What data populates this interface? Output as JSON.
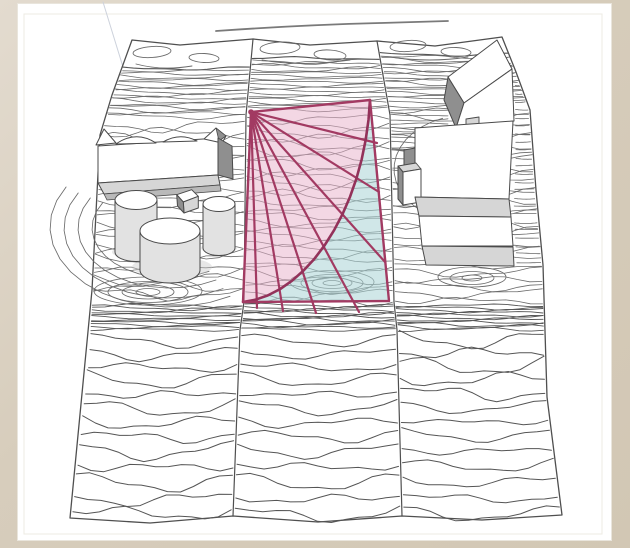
{
  "scene": {
    "kind": "3d-site-contour-model",
    "lots": 3,
    "left_cluster": {
      "slab_buildings": 1,
      "cylinders": 3,
      "small_box": 1
    },
    "right_cluster": {
      "boxes": 5
    },
    "parcel_overlay": {
      "rays": 7,
      "has_arc": true,
      "zones": [
        "pink-sector",
        "blue-remainder"
      ]
    }
  },
  "colors": {
    "frame_bg": "#d7cdbc",
    "card_bg": "#ffffff",
    "card_border": "#e9e5dc",
    "inner_line": "#edebe3",
    "contour": "#6a6a6a",
    "contour_dark": "#555555",
    "terrain_outline": "#4f4f4f",
    "building_stroke": "#4a4a4a",
    "face_white": "#ffffff",
    "side_light": "#d6d6d6",
    "side_mid": "#b9b9b9",
    "side_dark": "#8f8f8f",
    "cyl_body": "#e2e2e2",
    "ground_shadow": "#c9c9c9",
    "overlay_pink": "#e7b0c9",
    "overlay_blue": "#a9d3d6",
    "overlay_line": "#a23a62",
    "overlay_arc": "#93325a",
    "road_line": "#7a7a7a",
    "guide_line": "#cdd2dc"
  }
}
